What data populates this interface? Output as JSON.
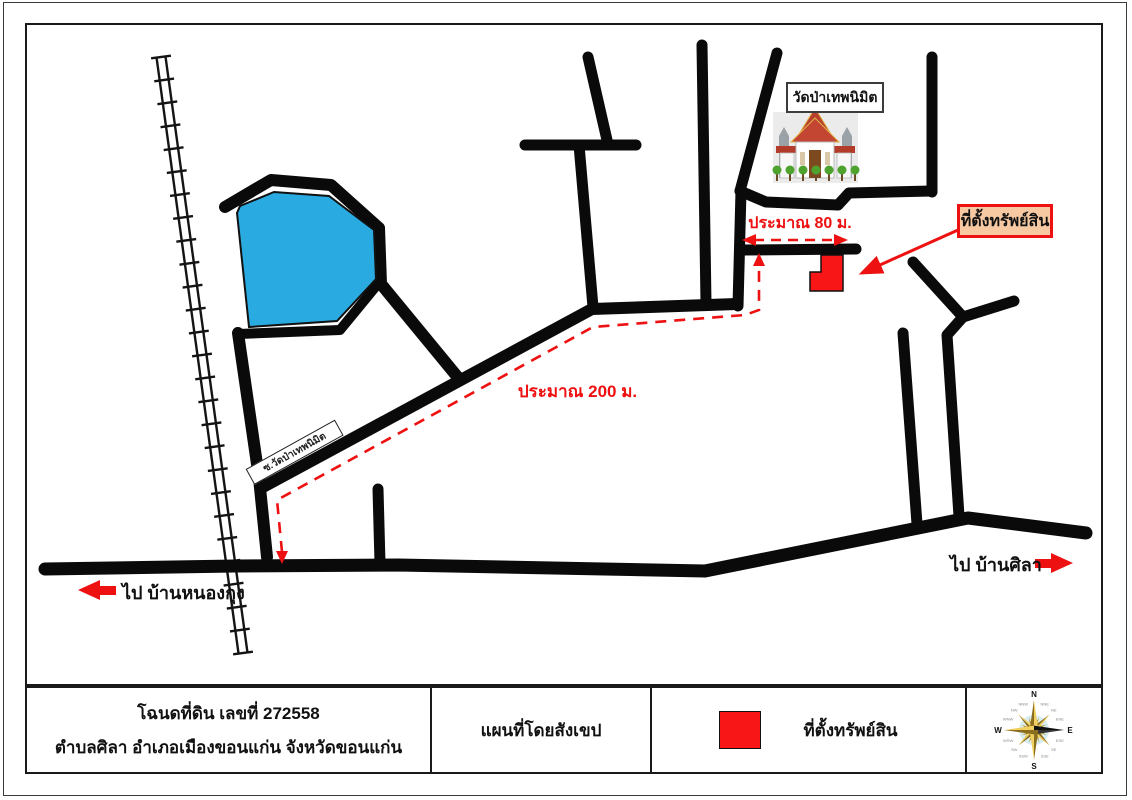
{
  "map": {
    "temple_label": "วัดป่าเทพนิมิต",
    "property_label": "ที่ตั้งทรัพย์สิน",
    "distance_80": "ประมาณ 80 ม.",
    "distance_200": "ประมาณ 200 ม.",
    "soi_label": "ซ.วัดป่าเทพนิมิต",
    "dir_left": "ไป บ้านหนองกุง",
    "dir_right": "ไป บ้านศิลา"
  },
  "footer": {
    "deed_line1": "โฉนดที่ดิน เลขที่ 272558",
    "deed_line2": "ตำบลศิลา อำเภอเมืองขอนแก่น จังหวัดขอนแก่น",
    "map_type": "แผนที่โดยสังเขป",
    "legend_label": "ที่ตั้งทรัพย์สิน"
  },
  "compass": {
    "cardinal": [
      "N",
      "E",
      "S",
      "W"
    ],
    "secondary": [
      "NNE",
      "NE",
      "ENE",
      "ESE",
      "SE",
      "SSE",
      "SSW",
      "SW",
      "WSW",
      "WNW",
      "NW",
      "NNW"
    ]
  },
  "colors": {
    "road": "#0a0a0a",
    "pond": "#29abe2",
    "route_red": "#ee1111",
    "marker_red": "#f81616",
    "property_box_bg": "#f6c9a2",
    "compass_gold": "#e8c84a"
  }
}
